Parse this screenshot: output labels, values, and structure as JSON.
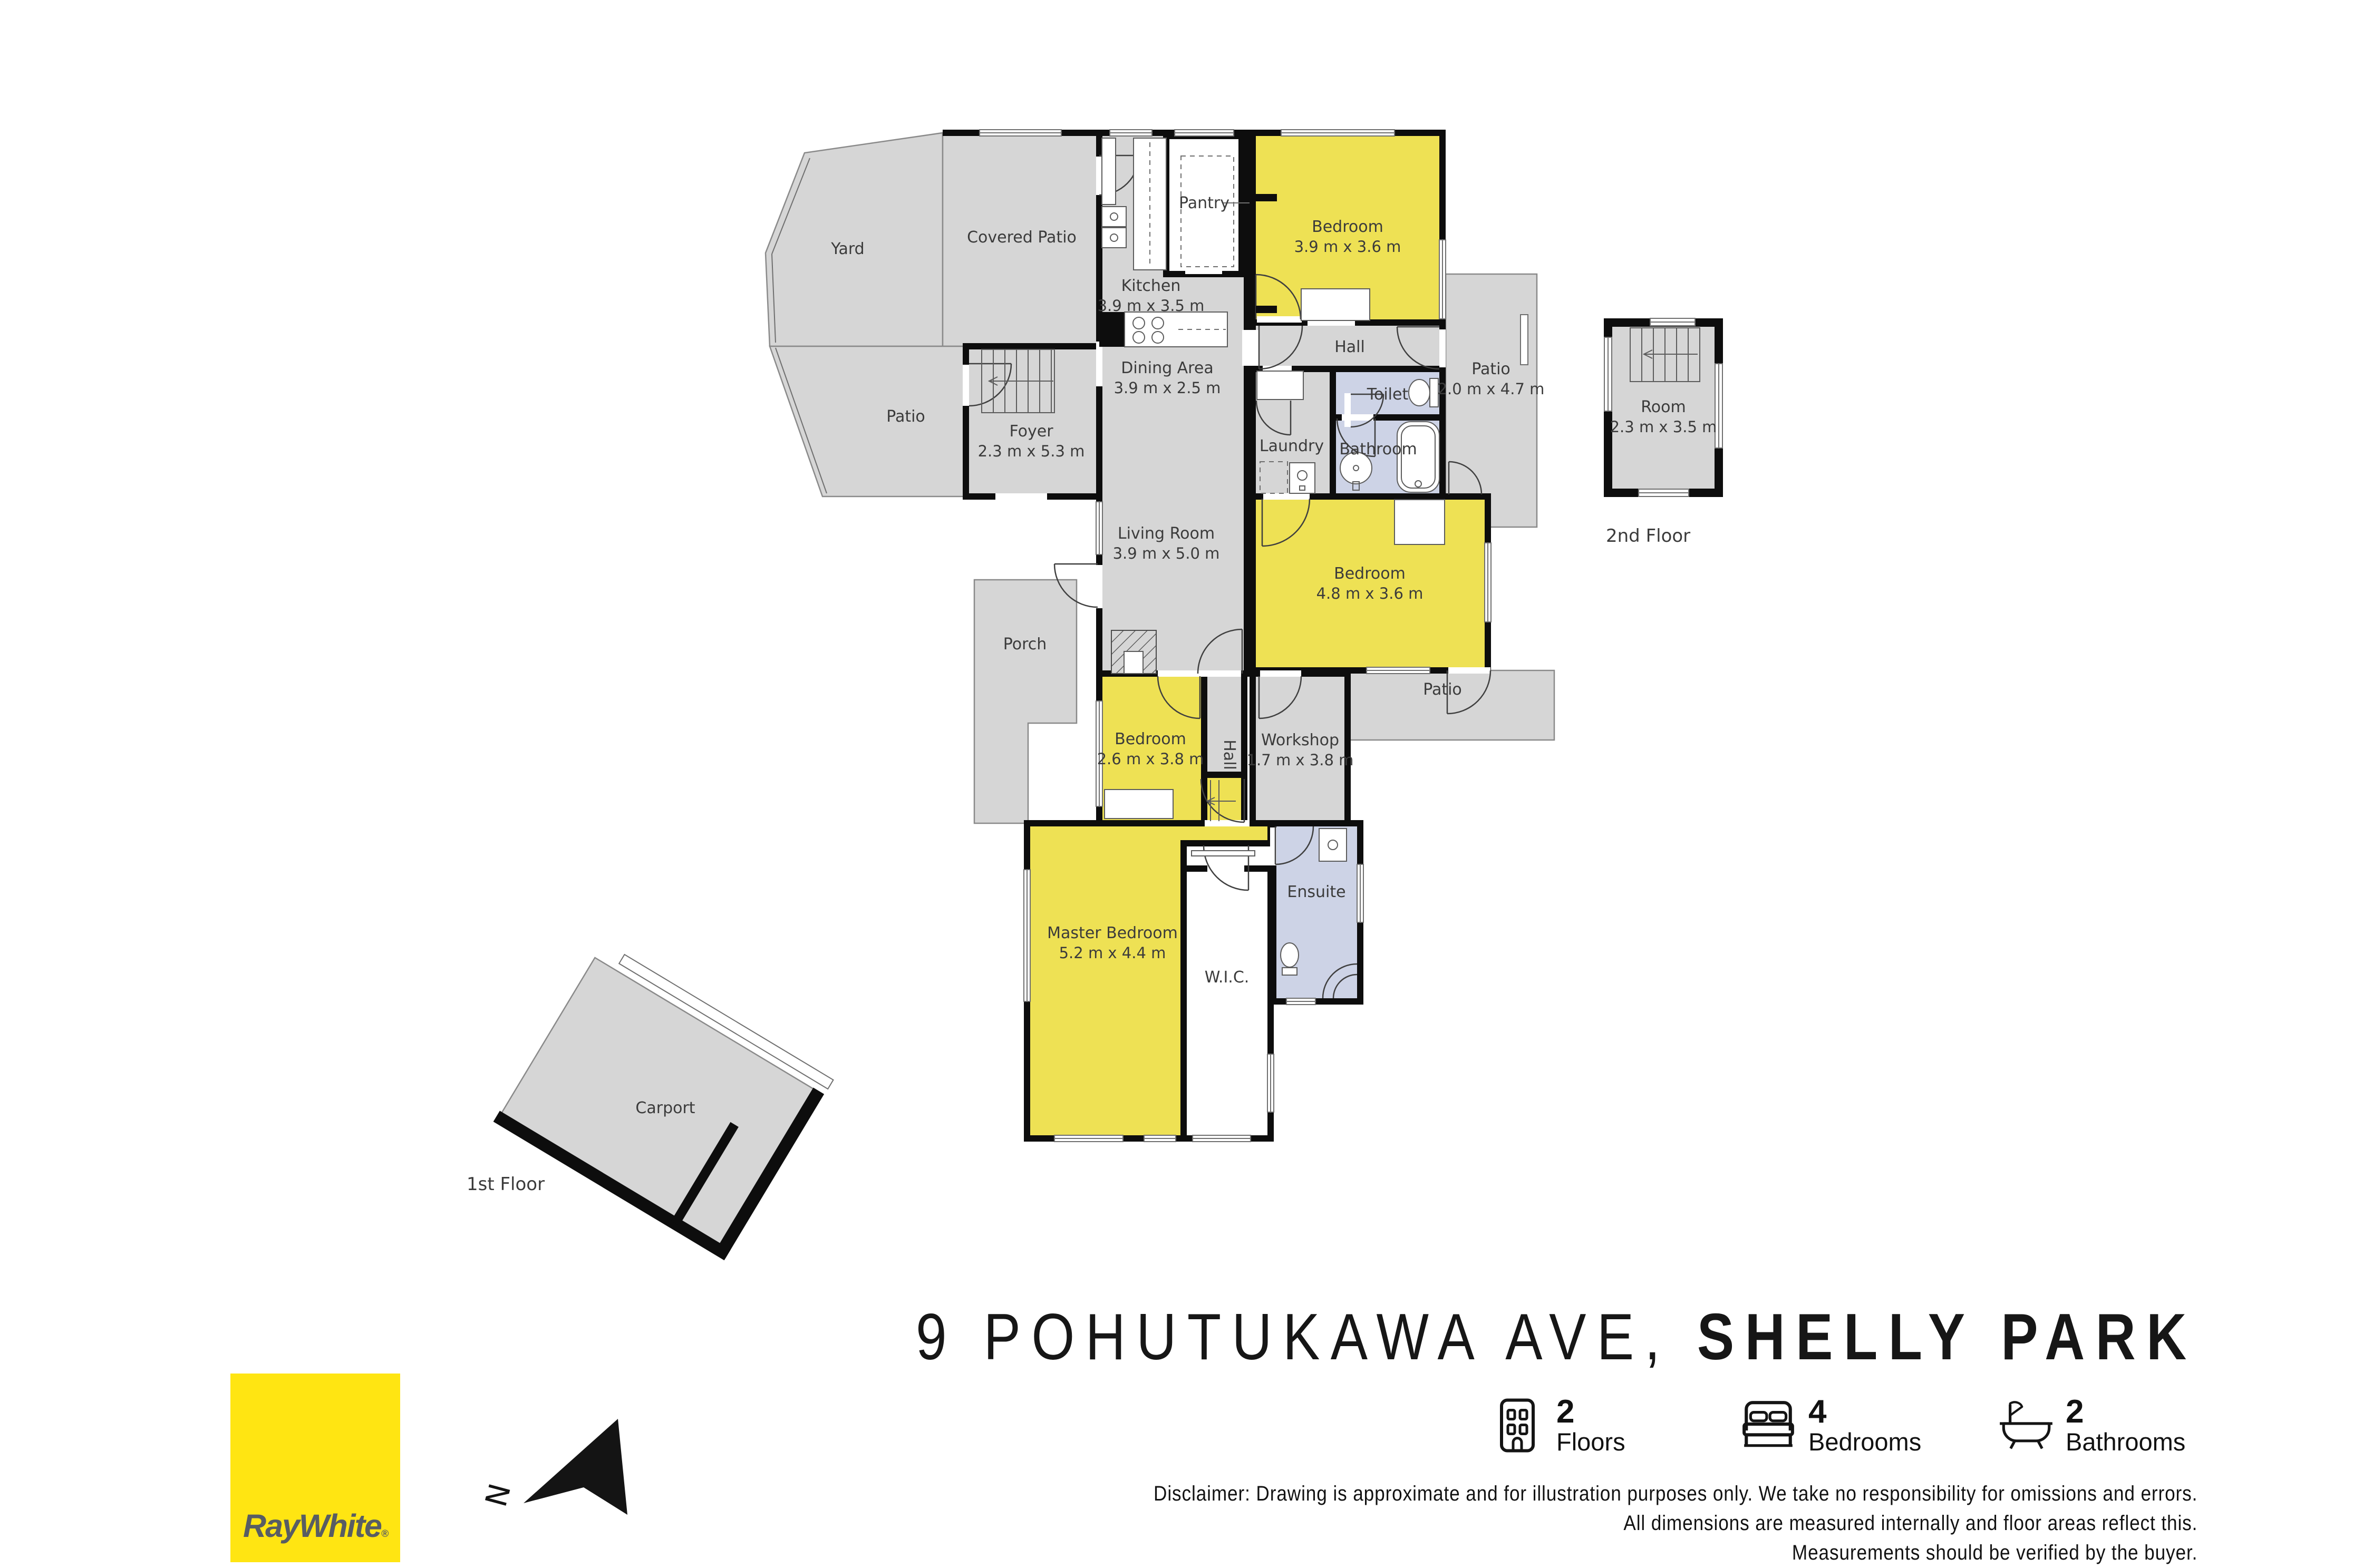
{
  "colors": {
    "room_gray": "#d6d6d6",
    "room_yellow": "#eee154",
    "room_blue": "#cdd3e6",
    "wall_black": "#0d0d0d",
    "logo_yellow": "#ffe512",
    "logo_text_gray": "#585d63"
  },
  "plan": {
    "floors": {
      "first": "1st Floor",
      "second": "2nd Floor"
    },
    "rooms": {
      "yard": {
        "name": "Yard"
      },
      "covered_patio": {
        "name": "Covered Patio"
      },
      "kitchen": {
        "name": "Kitchen",
        "dims": "3.9 m x 3.5 m"
      },
      "pantry": {
        "name": "Pantry"
      },
      "bedroom_top": {
        "name": "Bedroom",
        "dims": "3.9 m x 3.6 m"
      },
      "hall_upper": {
        "name": "Hall"
      },
      "patio_upper": {
        "name": "Patio",
        "dims": "2.0 m x 4.7 m"
      },
      "toilet": {
        "name": "Toilet"
      },
      "laundry": {
        "name": "Laundry"
      },
      "bathroom": {
        "name": "Bathroom"
      },
      "dining": {
        "name": "Dining Area",
        "dims": "3.9 m x 2.5 m"
      },
      "foyer": {
        "name": "Foyer",
        "dims": "2.3 m x 5.3 m"
      },
      "patio_left": {
        "name": "Patio"
      },
      "living": {
        "name": "Living Room",
        "dims": "3.9 m x 5.0 m"
      },
      "bedroom_mid": {
        "name": "Bedroom",
        "dims": "4.8 m x 3.6 m"
      },
      "porch": {
        "name": "Porch"
      },
      "patio_lower": {
        "name": "Patio"
      },
      "bedroom_small": {
        "name": "Bedroom",
        "dims": "2.6 m x 3.8 m"
      },
      "hall_lower": {
        "name": "Hall"
      },
      "workshop": {
        "name": "Workshop",
        "dims": "1.7 m x 3.8 m"
      },
      "master": {
        "name": "Master Bedroom",
        "dims": "5.2 m x 4.4 m"
      },
      "wic": {
        "name": "W.I.C."
      },
      "ensuite": {
        "name": "Ensuite"
      },
      "room_2nd": {
        "name": "Room",
        "dims": "2.3 m x 3.5 m"
      },
      "carport": {
        "name": "Carport"
      }
    }
  },
  "title": {
    "address": "9 POHUTUKAWA AVE,",
    "suburb": "SHELLY PARK"
  },
  "stats": {
    "floors": {
      "value": "2",
      "label": "Floors"
    },
    "bedrooms": {
      "value": "4",
      "label": "Bedrooms"
    },
    "bathrooms": {
      "value": "2",
      "label": "Bathrooms"
    }
  },
  "disclaimer": {
    "line1": "Disclaimer: Drawing is approximate and for illustration purposes only. We take no responsibility for omissions and errors.",
    "line2": "All dimensions are measured internally and floor areas reflect this.",
    "line3": "Measurements should be verified by the buyer."
  },
  "logo": {
    "brand": "RayWhite",
    "mark": "®"
  },
  "compass": {
    "label": "N"
  }
}
